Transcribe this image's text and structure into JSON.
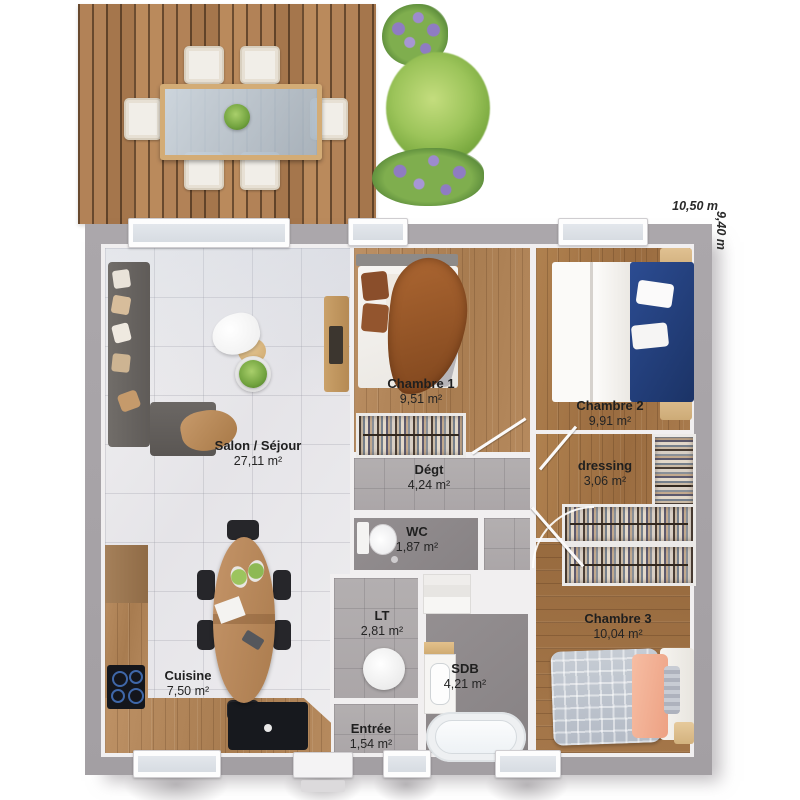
{
  "document": {
    "type": "architectural floor plan, top view 3D render"
  },
  "dimensions": {
    "width_label": "10,50 m",
    "height_label": "9,40 m"
  },
  "rooms": {
    "salon": {
      "name": "Salon / Séjour",
      "area": "27,11 m²"
    },
    "cuisine": {
      "name": "Cuisine",
      "area": "7,50 m²"
    },
    "chambre1": {
      "name": "Chambre 1",
      "area": "9,51 m²"
    },
    "chambre2": {
      "name": "Chambre 2",
      "area": "9,91 m²"
    },
    "chambre3": {
      "name": "Chambre 3",
      "area": "10,04 m²"
    },
    "dressing": {
      "name": "dressing",
      "area": "3,06 m²"
    },
    "degagement": {
      "name": "Dégt",
      "area": "4,24 m²"
    },
    "wc": {
      "name": "WC",
      "area": "1,87 m²"
    },
    "lt": {
      "name": "LT",
      "area": "2,81 m²"
    },
    "sdb": {
      "name": "SDB",
      "area": "4,21 m²"
    },
    "entree": {
      "name": "Entrée",
      "area": "1,54 m²"
    }
  },
  "colors": {
    "deck_wood": "#a87a50",
    "floor_wood_light": "#b58a5e",
    "floor_wood_dark": "#9c6f44",
    "exterior_wall": "#a9a5a9",
    "tile_floor": "#ededee",
    "gray_floor": "#b2aeaf",
    "dark_gray_floor": "#8b8688",
    "sofa_gray": "#6a6662",
    "bed1_blanket_orange": "#a35e2c",
    "bed2_navy": "#23407e",
    "bed3_peach": "#f3b69c",
    "plant_green": "#82b34e",
    "lavender_purple": "#8f7cc2"
  }
}
